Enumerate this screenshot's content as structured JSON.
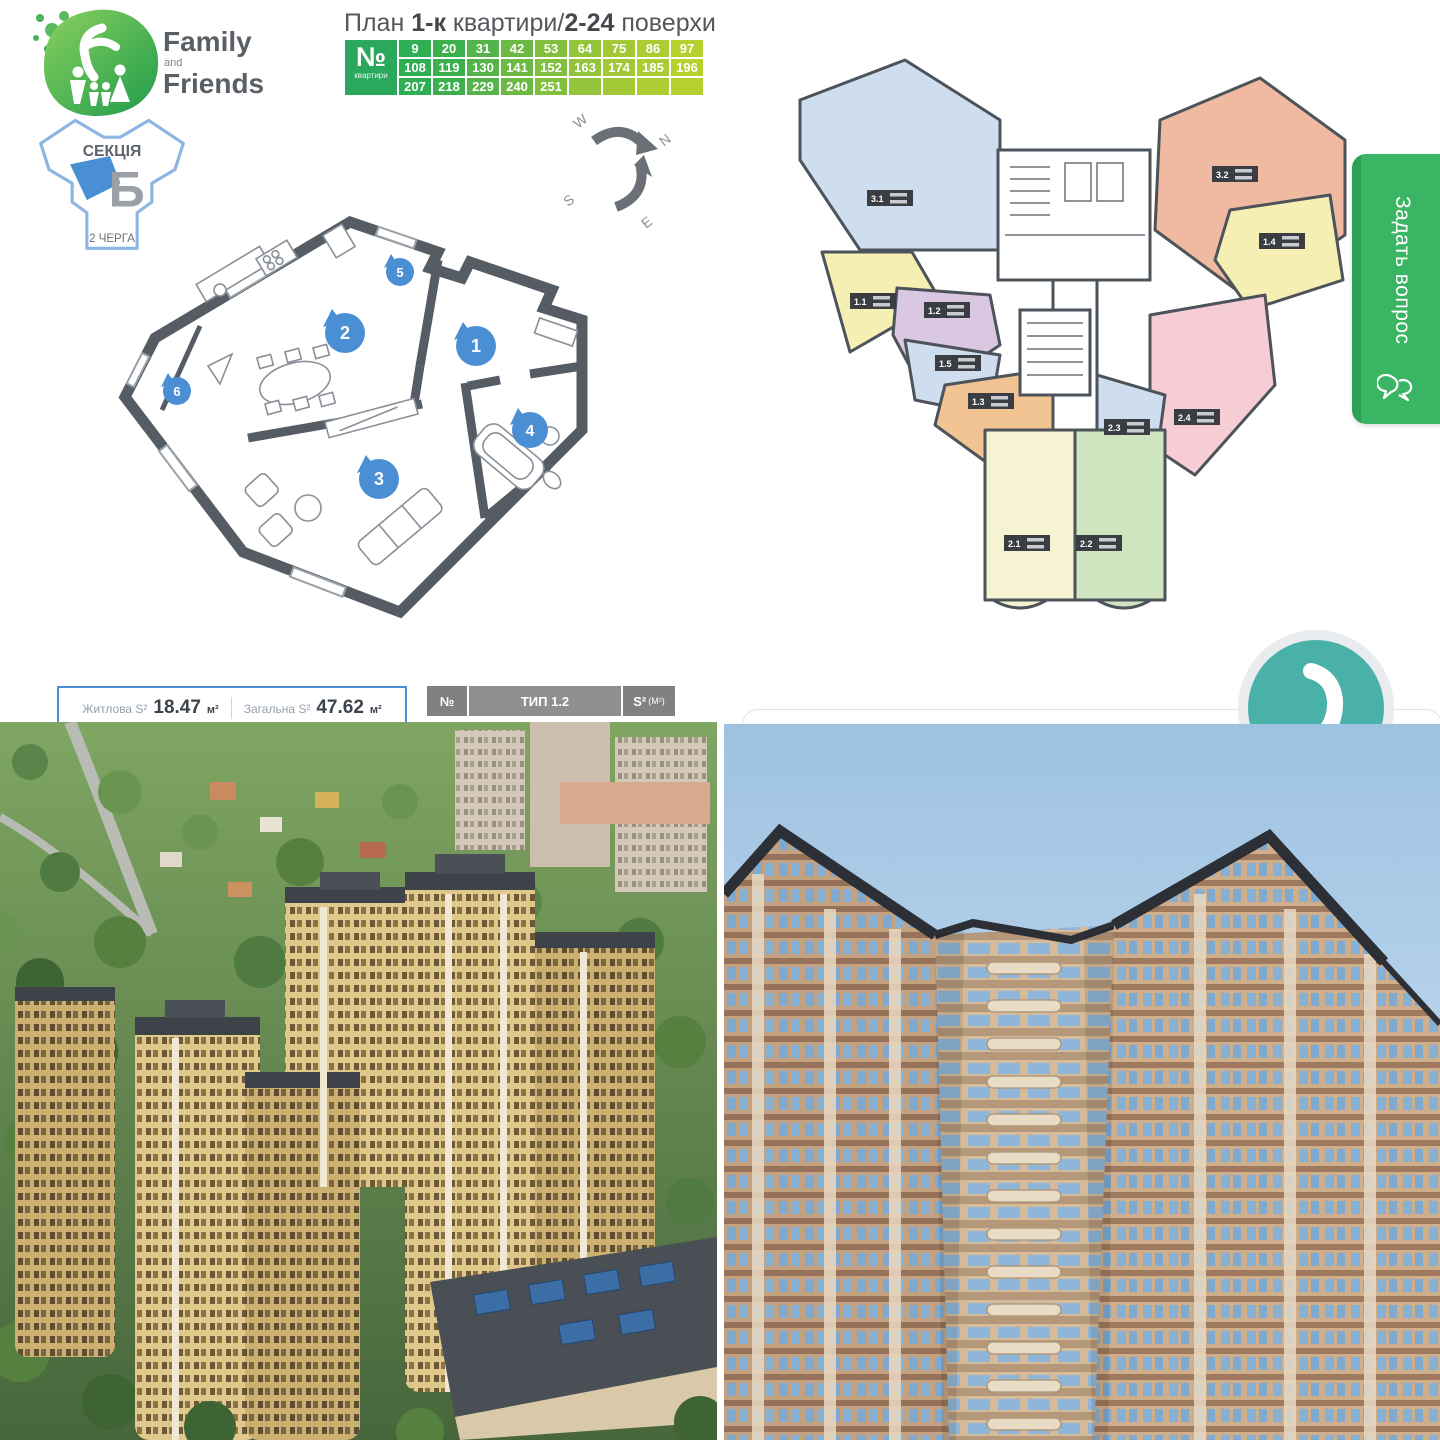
{
  "colors": {
    "accent_blue": "#4a8fd3",
    "brand_green": "#3aa655",
    "button_green": "#39b563",
    "widget_teal": "#4ab1a9",
    "wall_gray": "#565c64"
  },
  "brand": {
    "top": "Family",
    "mid": "and",
    "bottom": "Friends"
  },
  "plan_title": {
    "t1": "План ",
    "b1": "1-к",
    "t2": " квартири",
    "sep": "/",
    "b2": "2-24",
    "t3": " поверхи"
  },
  "apartment_numbers": {
    "corner": "№",
    "corner_sub": "квартири",
    "rows": [
      [
        "9",
        "20",
        "31",
        "42",
        "53",
        "64",
        "75",
        "86",
        "97"
      ],
      [
        "108",
        "119",
        "130",
        "141",
        "152",
        "163",
        "174",
        "185",
        "196"
      ],
      [
        "207",
        "218",
        "229",
        "240",
        "251",
        "",
        "",
        "",
        ""
      ]
    ]
  },
  "section": {
    "label": "СЕКЦІЯ",
    "letter": "Б",
    "phase": "2 ЧЕРГА"
  },
  "compass": {
    "n": "N",
    "e": "E",
    "s": "S",
    "w": "W"
  },
  "rooms": [
    "1",
    "2",
    "3",
    "4",
    "5",
    "6"
  ],
  "areas": {
    "living_label": "Житлова S²",
    "living_value": "18.47",
    "living_unit": "м²",
    "total_label": "Загальна S²",
    "total_value": "47.62",
    "total_unit": "м²"
  },
  "type_bar": {
    "no": "№",
    "type": "ТИП 1.2",
    "area": "S²",
    "area_unit": "(М²)"
  },
  "units": [
    {
      "label": "3.1",
      "color": "#cfdeee"
    },
    {
      "label": "1.1",
      "color": "#f6efb3"
    },
    {
      "label": "1.2",
      "color": "#dac7e1"
    },
    {
      "label": "1.5",
      "color": "#cfdeee"
    },
    {
      "label": "1.3",
      "color": "#f3c493"
    },
    {
      "label": "3.2",
      "color": "#efbaa1"
    },
    {
      "label": "1.4",
      "color": "#f6efb3"
    },
    {
      "label": "2.4",
      "color": "#f6cdd5"
    },
    {
      "label": "2.3",
      "color": "#cfdeee"
    },
    {
      "label": "2.1",
      "color": "#f5f3d1"
    },
    {
      "label": "2.2",
      "color": "#cfe5c0"
    }
  ],
  "ask_button": {
    "label": "Задать вопрос"
  }
}
